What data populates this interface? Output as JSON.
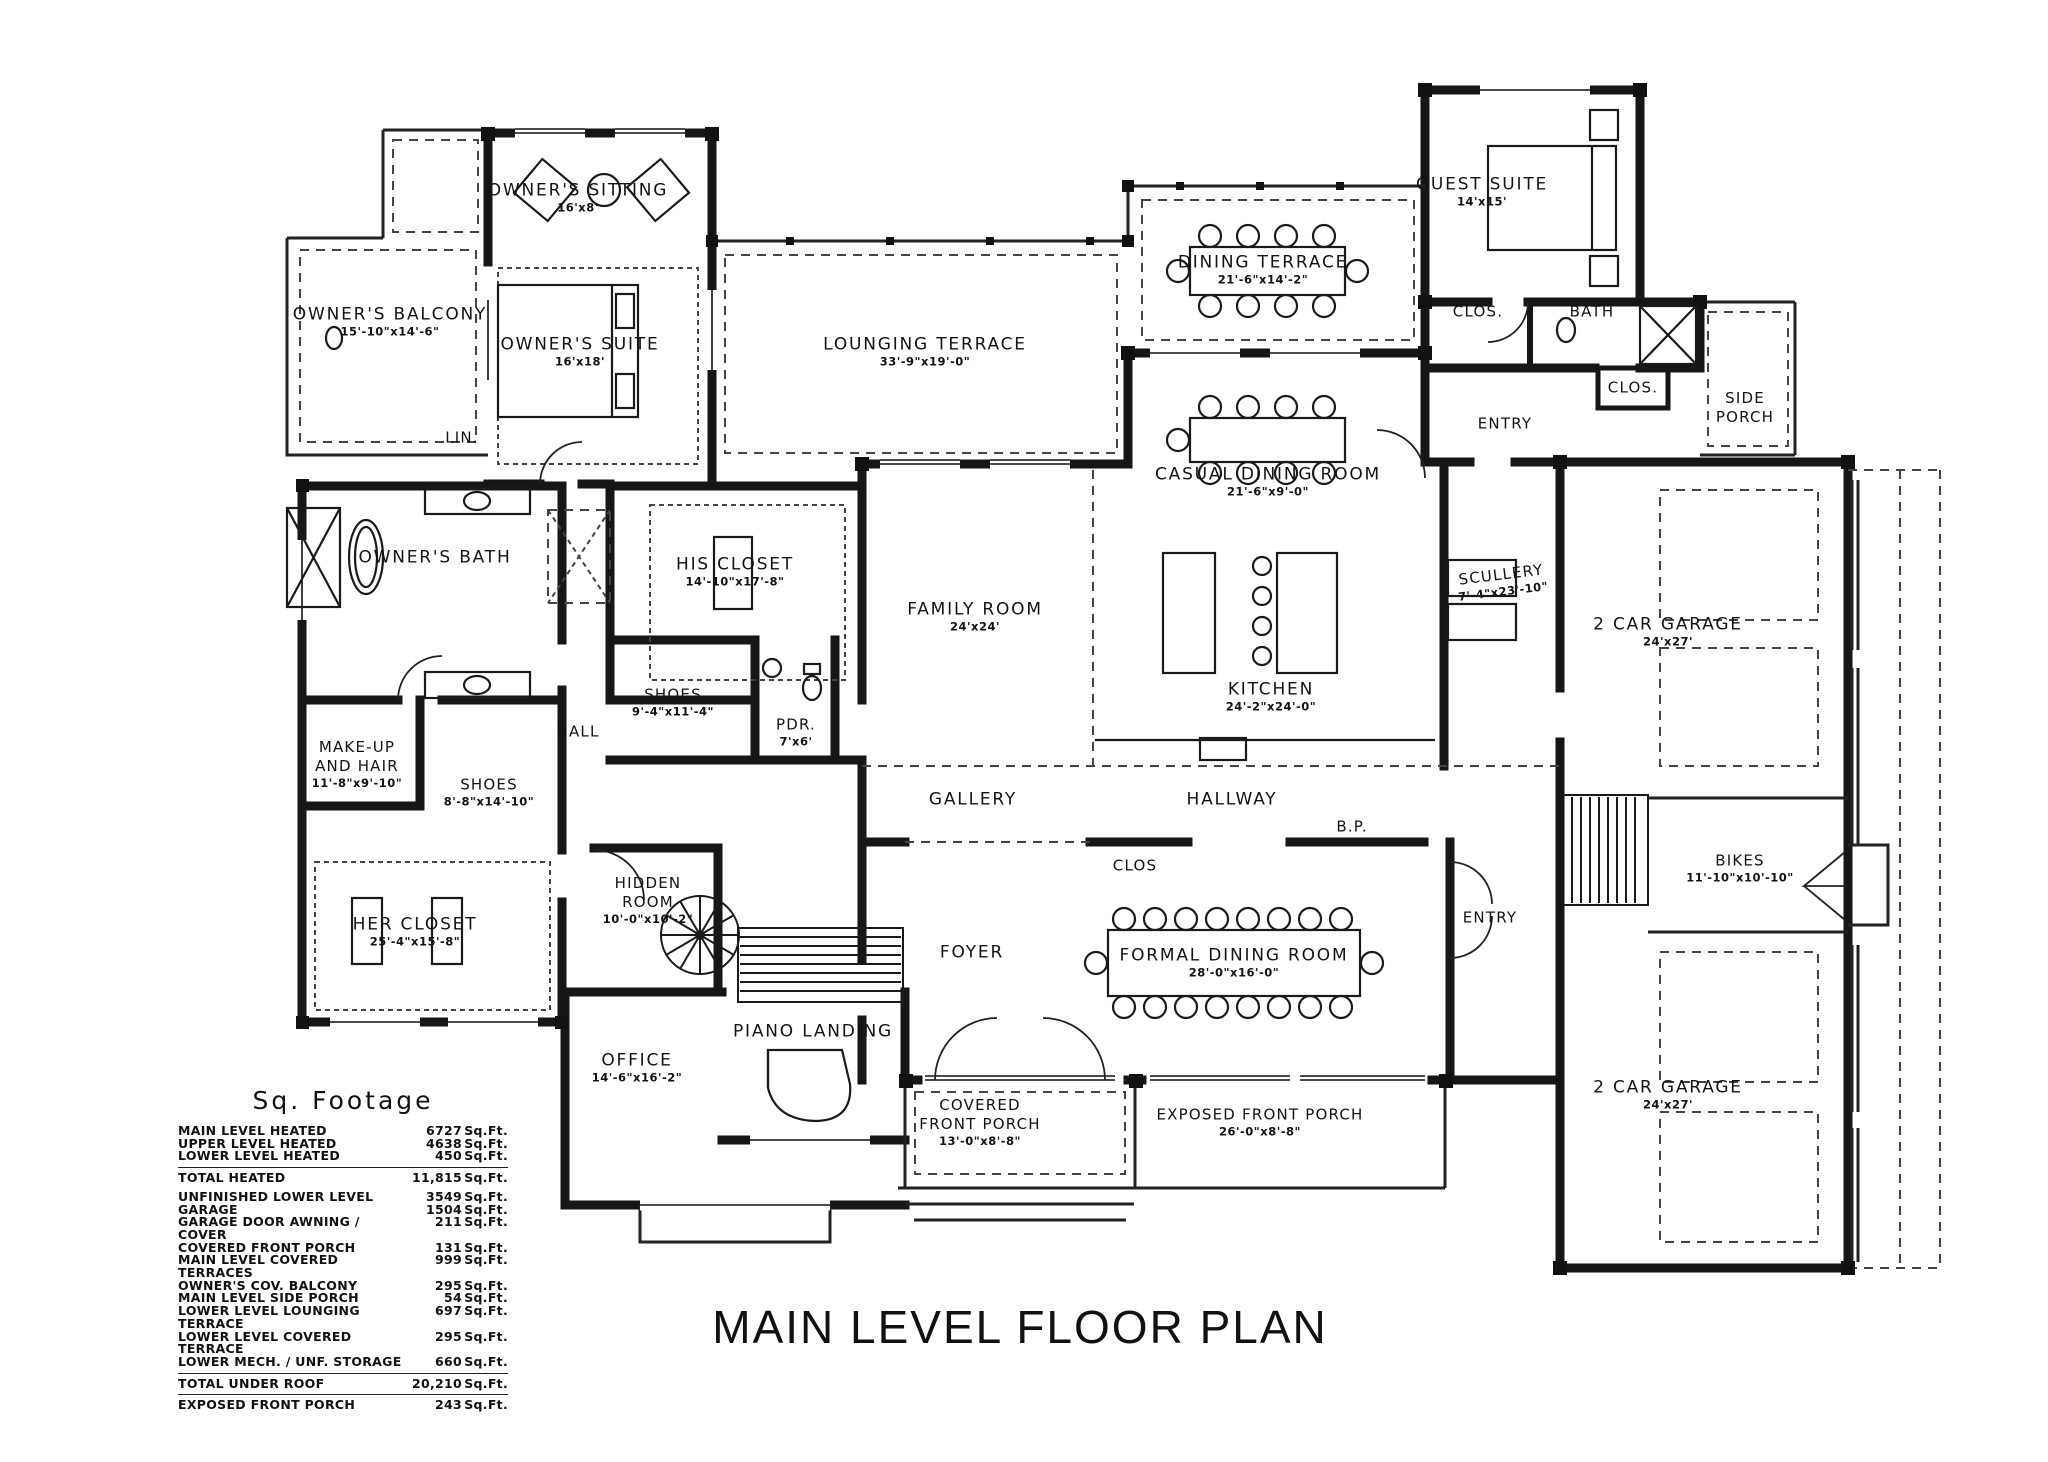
{
  "title": "MAIN LEVEL FLOOR PLAN",
  "sq_footage": {
    "heading": "Sq. Footage",
    "unit": "Sq.Ft.",
    "rows": [
      {
        "label": "MAIN LEVEL HEATED",
        "value": "6727",
        "unit": "Sq.Ft."
      },
      {
        "label": "UPPER LEVEL HEATED",
        "value": "4638",
        "unit": "Sq.Ft."
      },
      {
        "label": "LOWER LEVEL HEATED",
        "value": "450",
        "unit": "Sq.Ft."
      },
      {
        "label": "TOTAL HEATED",
        "value": "11,815",
        "unit": "Sq.Ft."
      },
      {
        "label": "UNFINISHED LOWER LEVEL",
        "value": "3549",
        "unit": "Sq.Ft."
      },
      {
        "label": "GARAGE",
        "value": "1504",
        "unit": "Sq.Ft."
      },
      {
        "label": "GARAGE DOOR AWNING / COVER",
        "value": "211",
        "unit": "Sq.Ft."
      },
      {
        "label": "COVERED FRONT PORCH",
        "value": "131",
        "unit": "Sq.Ft."
      },
      {
        "label": "MAIN LEVEL COVERED TERRACES",
        "value": "999",
        "unit": "Sq.Ft."
      },
      {
        "label": "OWNER'S COV. BALCONY",
        "value": "295",
        "unit": "Sq.Ft."
      },
      {
        "label": "MAIN LEVEL SIDE PORCH",
        "value": "54",
        "unit": "Sq.Ft."
      },
      {
        "label": "LOWER LEVEL LOUNGING TERRACE",
        "value": "697",
        "unit": "Sq.Ft."
      },
      {
        "label": "LOWER LEVEL COVERED TERRACE",
        "value": "295",
        "unit": "Sq.Ft."
      },
      {
        "label": "LOWER MECH. / UNF. STORAGE",
        "value": "660",
        "unit": "Sq.Ft."
      },
      {
        "label": "TOTAL UNDER ROOF",
        "value": "20,210",
        "unit": "Sq.Ft."
      },
      {
        "label": "EXPOSED FRONT PORCH",
        "value": "243",
        "unit": "Sq.Ft."
      }
    ]
  },
  "rooms": [
    {
      "name": "OWNER'S SITTING",
      "dims": "16'x8'"
    },
    {
      "name": "OWNER'S BALCONY",
      "dims": "15'-10\"x14'-6\""
    },
    {
      "name": "OWNER'S SUITE",
      "dims": "16'x18'"
    },
    {
      "name": "LOUNGING TERRACE",
      "dims": "33'-9\"x19'-0\""
    },
    {
      "name": "DINING TERRACE",
      "dims": "21'-6\"x14'-2\""
    },
    {
      "name": "GUEST SUITE",
      "dims": "14'x15'"
    },
    {
      "name": "CLOS.",
      "dims": ""
    },
    {
      "name": "BATH",
      "dims": ""
    },
    {
      "name": "CLOS.",
      "dims": ""
    },
    {
      "name": "SIDE\nPORCH",
      "dims": ""
    },
    {
      "name": "ENTRY",
      "dims": ""
    },
    {
      "name": "CASUAL DINING ROOM",
      "dims": "21'-6\"x9'-0\""
    },
    {
      "name": "LIN.",
      "dims": ""
    },
    {
      "name": "OWNER'S BATH",
      "dims": ""
    },
    {
      "name": "HIS CLOSET",
      "dims": "14'-10\"x17'-8\""
    },
    {
      "name": "FAMILY ROOM",
      "dims": "24'x24'"
    },
    {
      "name": "SCULLERY",
      "dims": "7'-4\"x23'-10\""
    },
    {
      "name": "KITCHEN",
      "dims": "24'-2\"x24'-0\""
    },
    {
      "name": "SHOES",
      "dims": "9'-4\"x11'-4\""
    },
    {
      "name": "PDR.",
      "dims": "7'x6'"
    },
    {
      "name": "HALL",
      "dims": ""
    },
    {
      "name": "MAKE-UP\nAND HAIR",
      "dims": "11'-8\"x9'-10\""
    },
    {
      "name": "SHOES",
      "dims": "8'-8\"x14'-10\""
    },
    {
      "name": "GALLERY",
      "dims": ""
    },
    {
      "name": "HALLWAY",
      "dims": ""
    },
    {
      "name": "CLOS",
      "dims": ""
    },
    {
      "name": "B.P.",
      "dims": ""
    },
    {
      "name": "HIDDEN\nROOM",
      "dims": "10'-0\"x10'-2\""
    },
    {
      "name": "HER CLOSET",
      "dims": "25'-4\"x15'-8\""
    },
    {
      "name": "ENTRY",
      "dims": ""
    },
    {
      "name": "2 CAR GARAGE",
      "dims": "24'x27'"
    },
    {
      "name": "BIKES",
      "dims": "11'-10\"x10'-10\""
    },
    {
      "name": "FOYER",
      "dims": ""
    },
    {
      "name": "FORMAL DINING ROOM",
      "dims": "28'-0\"x16'-0\""
    },
    {
      "name": "OFFICE",
      "dims": "14'-6\"x16'-2\""
    },
    {
      "name": "PIANO LANDING",
      "dims": ""
    },
    {
      "name": "COVERED\nFRONT PORCH",
      "dims": "13'-0\"x8'-8\""
    },
    {
      "name": "EXPOSED FRONT PORCH",
      "dims": "26'-0\"x8'-8\""
    },
    {
      "name": "2 CAR GARAGE",
      "dims": "24'x27'"
    }
  ]
}
